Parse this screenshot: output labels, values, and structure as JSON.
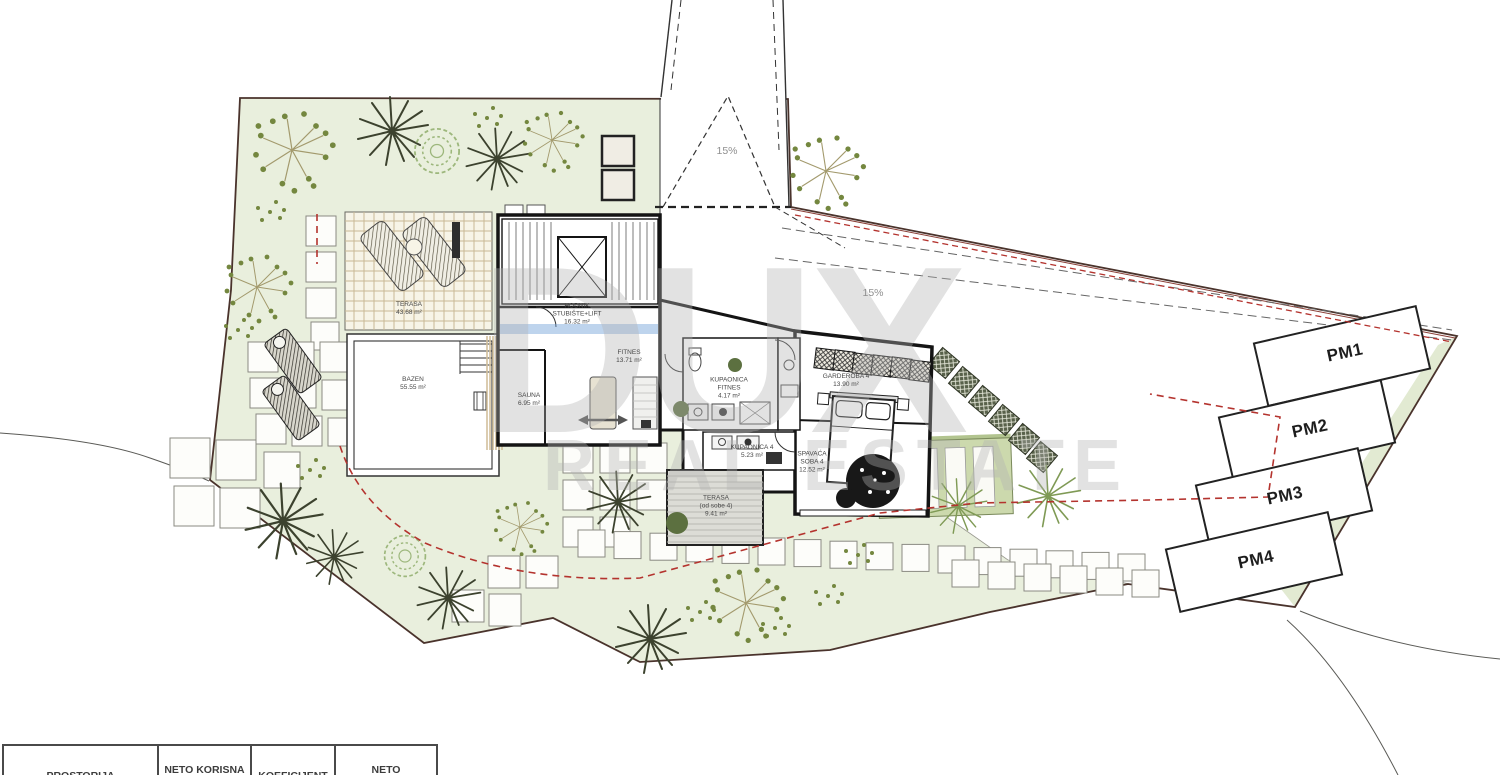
{
  "watermark": {
    "line1": "DUX",
    "line2": "REAL ESTATE"
  },
  "slope_labels": [
    {
      "text": "15%"
    },
    {
      "text": "15%"
    }
  ],
  "parking": [
    {
      "label": "PM1"
    },
    {
      "label": "PM2"
    },
    {
      "label": "PM3"
    },
    {
      "label": "PM4"
    }
  ],
  "rooms": [
    {
      "id": "terasa-pergola",
      "lines": [
        "TERASA",
        "43.68 m²"
      ]
    },
    {
      "id": "bazen",
      "lines": [
        "BAZEN",
        "55.55 m²"
      ]
    },
    {
      "id": "sauna",
      "lines": [
        "SAUNA",
        "6.95 m²"
      ]
    },
    {
      "id": "hodnik",
      "lines": [
        "HODNIK",
        "STUBIŠTE+LIFT",
        "16.32 m²"
      ]
    },
    {
      "id": "fitnes",
      "lines": [
        "FITNES",
        "13.71 m²"
      ]
    },
    {
      "id": "kupaonica-fitnes",
      "lines": [
        "KUPAONICA",
        "FITNES",
        "4.17 m²"
      ]
    },
    {
      "id": "garderoba-4",
      "lines": [
        "GARDEROBA 4",
        "13.90 m²"
      ]
    },
    {
      "id": "kupaonica-4",
      "lines": [
        "KUPAONICA 4",
        "5.23 m²"
      ]
    },
    {
      "id": "spavaca-soba-4",
      "lines": [
        "SPAVAĆA",
        "SOBA 4",
        "12.52 m²"
      ]
    },
    {
      "id": "terasa-sobe-4",
      "lines": [
        "TERASA",
        "(od sobe 4)",
        "9.41 m²"
      ]
    }
  ],
  "table": {
    "headers": [
      [
        "PROSTORIJA"
      ],
      [
        "NETO KORISNA",
        "POVRŠINA (m²)"
      ],
      [
        "KOEFICIJENT"
      ],
      [
        "NETO",
        "OBRAČUNSKA"
      ]
    ]
  },
  "colors": {
    "garden_green": "#e9efdd",
    "boundary": "#4a332c",
    "setback_red": "#b4332e",
    "wall": "#141414"
  }
}
